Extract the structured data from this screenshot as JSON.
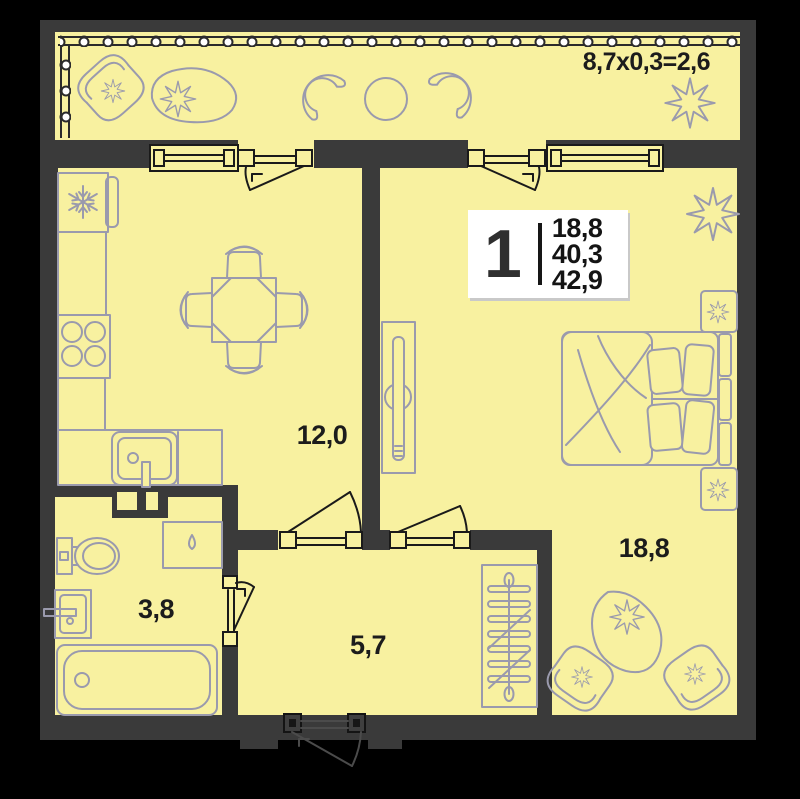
{
  "colors": {
    "background": "#000000",
    "walls": "#3a3a3a",
    "floor": "#f8f1a0",
    "furniture_outline": "#9a9aad",
    "label_text": "#1c1c1c",
    "info_box_bg": "#ffffff"
  },
  "balcony": {
    "dimension_label": "8,7x0,3=2,6"
  },
  "info_box": {
    "room_count": "1",
    "areas": [
      "18,8",
      "40,3",
      "42,9"
    ]
  },
  "rooms": {
    "kitchen_living": {
      "area_label": "12,0"
    },
    "bedroom": {
      "area_label": "18,8"
    },
    "bathroom": {
      "area_label": "3,8"
    },
    "hallway": {
      "area_label": "5,7"
    }
  },
  "icons": {
    "fridge": "snowflake-icon",
    "washing_machine": "water-drop-icon",
    "wardrobe": "hanging-rail-icon",
    "plants": "flower-icon"
  }
}
